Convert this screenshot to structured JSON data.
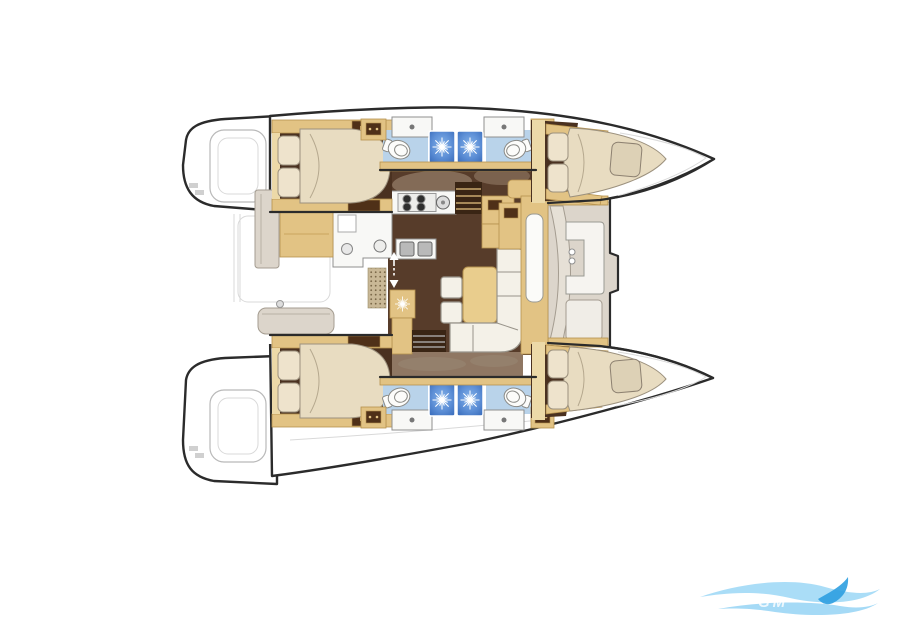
{
  "watermark": {
    "text": "GM"
  },
  "colors": {
    "outline": "#2b2b2b",
    "grayline": "#b9b9b9",
    "cabin": "#4a3120",
    "salon": "#573c2a",
    "stairs": "#3a2514",
    "tan": "#e2c384",
    "tanline": "#b6924e",
    "khaki": "#ecd9a8",
    "bed": "#e8dcc1",
    "duvet": "#e0cfae",
    "pillow": "#eee3cc",
    "pillowline": "#9c917e",
    "cream": "#f4f1e8",
    "creamline": "#98948a",
    "fixture": "#f8f8f6",
    "fixline": "#8f8f8f",
    "bath": "#b9d3ea",
    "shower": "#4f86d2",
    "greige": "#dcd5cb",
    "greigeline": "#a49c90",
    "taupe": "#8f7763",
    "hullband": "#7b6553",
    "wmlight": "#8ed2f4",
    "wmmid": "#5bbcee",
    "wmdark": "#2d9fe0"
  },
  "diagram": {
    "type": "floorplan",
    "subject": "Catamaran yacht interior layout, overhead view",
    "orientation": "bows pointing right, twin hulls top and bottom, saloon on center bridgedeck",
    "port_hull": {
      "aft_cabin": {
        "features": [
          "island double bed",
          "2 pillows",
          "storage locker hatches"
        ]
      },
      "aft_bathroom": {
        "features": [
          "toilet",
          "washbasin counter",
          "shower with drain rose"
        ]
      },
      "forward_bathroom": {
        "features": [
          "toilet",
          "washbasin counter",
          "shower with drain rose"
        ]
      },
      "forward_cabin": {
        "features": [
          "double berth in bow",
          "2 pillows",
          "seat cushion"
        ]
      }
    },
    "starboard_hull": {
      "aft_cabin": {
        "features": [
          "island double bed",
          "2 pillows",
          "storage locker hatches"
        ]
      },
      "aft_bathroom": {
        "features": [
          "toilet",
          "washbasin counter",
          "shower with drain rose"
        ]
      },
      "forward_bathroom": {
        "features": [
          "toilet",
          "washbasin counter",
          "shower with drain rose"
        ]
      },
      "forward_cabin": {
        "features": [
          "double berth in bow",
          "2 pillows",
          "seat cushion"
        ]
      }
    },
    "saloon": {
      "galley": {
        "features": [
          "4-burner stove",
          "auxiliary round burner",
          "double sink",
          "round sink",
          "L-shaped worktop",
          "appliance cabinet"
        ]
      },
      "dinette": {
        "features": [
          "L-shaped sofa",
          "rectangular table",
          "2 ottoman stools"
        ]
      },
      "companionways": [
        "steps down to port hull",
        "steps down to starboard hull",
        "up/down arrow marks"
      ],
      "other": [
        "khaki sideboard",
        "deck fitting rosette",
        "dotted floor mat"
      ]
    },
    "forward_cockpit": {
      "features": [
        "curved backrest panel",
        "C-shaped seat with table",
        "2 cup holders",
        "bench"
      ]
    },
    "aft_deck": {
      "features": [
        "bench seat",
        "side panel",
        "transom platforms with steps"
      ]
    }
  }
}
